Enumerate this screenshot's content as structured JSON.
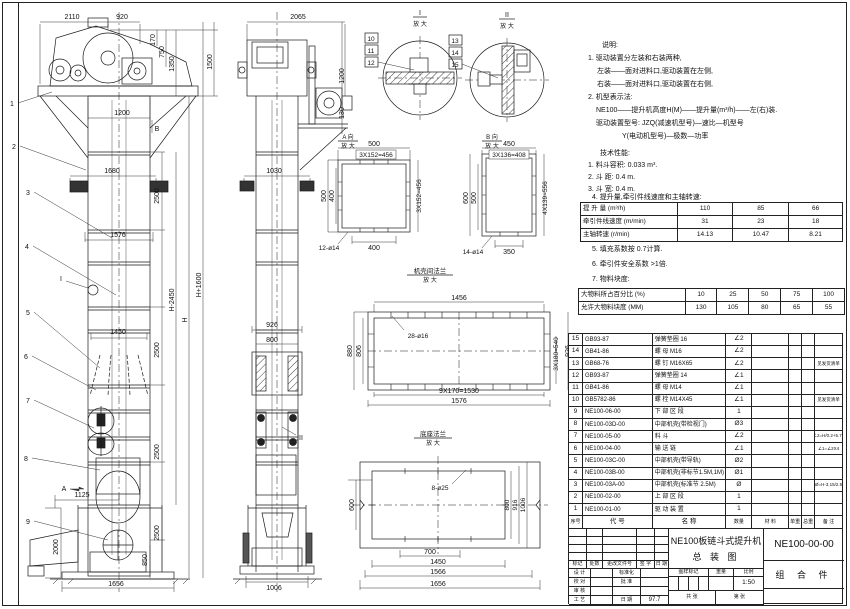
{
  "notes": {
    "title": "说明:",
    "lines": [
      "1. 驱动装置分左装和右装两种,",
      "左装——面对进料口,驱动装置在左侧,",
      "右装——面对进料口,驱动装置在右侧,",
      "2. 机型表示法:",
      "NE100——提升机高度H(M)——提升量(m³/h)——左(右)装.",
      "驱动装置型号: JZQ(减速机型号)—速比—机型号",
      "Y(电动机型号)—极数—功率"
    ]
  },
  "tech": {
    "title": "技术性能:",
    "items_before": [
      "1. 料斗容积: 0.033 m³.",
      "2. 斗  距: 0.4 m.",
      "3. 斗  宽: 0.4 m.",
      "4. 提升量,牵引件线速度和主轴转速:"
    ],
    "perf_table": {
      "rows": [
        {
          "label": "提 升 量  (m³/h)",
          "c1": "110",
          "c2": "85",
          "c3": "66"
        },
        {
          "label": "牵引件线速度 (m/min)",
          "c1": "31",
          "c2": "23",
          "c3": "18"
        },
        {
          "label": "主轴转速  (r/min)",
          "c1": "14.13",
          "c2": "10.47",
          "c3": "8.21"
        }
      ]
    },
    "items_after": [
      "5. 填充系数按 0.7计算.",
      "6. 牵引件安全系数 >1倍.",
      "7. 物料块度:"
    ],
    "block_table": {
      "rows": [
        {
          "label": "大物料所占百分比 (%)",
          "c1": "10",
          "c2": "25",
          "c3": "50",
          "c4": "75",
          "c5": "100"
        },
        {
          "label": "允许大物料块度 (MM)",
          "c1": "130",
          "c2": "105",
          "c3": "80",
          "c4": "65",
          "c5": "55"
        }
      ]
    }
  },
  "bom": {
    "headers": {
      "no": "序号",
      "code": "代  号",
      "name": "名  称",
      "qty": "数量",
      "material": "材 料",
      "uw": "单重",
      "tw": "总重",
      "remark": "备 注"
    },
    "rows": [
      {
        "no": "15",
        "code": "GB93-87",
        "name": "弹簧垫圈 16",
        "qty": "∠2",
        "material": "",
        "uw": "",
        "tw": "",
        "remark": ""
      },
      {
        "no": "14",
        "code": "GB41-86",
        "name": "螺 母 M16",
        "qty": "∠2",
        "material": "",
        "uw": "",
        "tw": "",
        "remark": ""
      },
      {
        "no": "13",
        "code": "GB68-76",
        "name": "螺 钉 M16X65",
        "qty": "∠2",
        "material": "",
        "uw": "",
        "tw": "",
        "remark": "见发货清单"
      },
      {
        "no": "12",
        "code": "GB93-87",
        "name": "弹簧垫圈 14",
        "qty": "∠1",
        "material": "",
        "uw": "",
        "tw": "",
        "remark": ""
      },
      {
        "no": "11",
        "code": "GB41-86",
        "name": "螺 母 M14",
        "qty": "∠1",
        "material": "",
        "uw": "",
        "tw": "",
        "remark": ""
      },
      {
        "no": "10",
        "code": "GB5782-86",
        "name": "螺 栓 M14X45",
        "qty": "∠1",
        "material": "",
        "uw": "",
        "tw": "",
        "remark": "见发货清单"
      },
      {
        "no": "9",
        "code": "NE100-06-00",
        "name": "下 部 区 段",
        "qty": "1",
        "material": "",
        "uw": "",
        "tw": "",
        "remark": ""
      },
      {
        "no": "8",
        "code": "NE100-03D-00",
        "name": "中部机壳(带检视门)",
        "qty": "Ø3",
        "material": "",
        "uw": "",
        "tw": "",
        "remark": ""
      },
      {
        "no": "7",
        "code": "NE100-05-00",
        "name": "料 斗",
        "qty": "∠2",
        "material": "",
        "uw": "",
        "tw": "",
        "remark": "∠2=H/0.2+5.75"
      },
      {
        "no": "6",
        "code": "NE100-04-00",
        "name": "输 送 链",
        "qty": "∠1",
        "material": "",
        "uw": "",
        "tw": "",
        "remark": "∠1=∠2X4"
      },
      {
        "no": "5",
        "code": "NE100-03C-00",
        "name": "中部机壳(带导轨)",
        "qty": "Ø2",
        "material": "",
        "uw": "",
        "tw": "",
        "remark": ""
      },
      {
        "no": "4",
        "code": "NE100-03B-00",
        "name": "中部机壳(非标节1.5M,1M)",
        "qty": "Ø1",
        "material": "",
        "uw": "",
        "tw": "",
        "remark": ""
      },
      {
        "no": "3",
        "code": "NE100-03A-00",
        "name": "中部机壳(标准节 2.5M)",
        "qty": "Ø",
        "material": "",
        "uw": "",
        "tw": "",
        "remark": "Ø=H-3.15/2.5"
      },
      {
        "no": "2",
        "code": "NE100-02-00",
        "name": "上 部 区 段",
        "qty": "1",
        "material": "",
        "uw": "",
        "tw": "",
        "remark": ""
      },
      {
        "no": "1",
        "code": "NE100-01-00",
        "name": "驱 动 装 置",
        "qty": "1",
        "material": "",
        "uw": "",
        "tw": "",
        "remark": ""
      }
    ]
  },
  "title_block": {
    "rev_headers": [
      "标记",
      "处数",
      "更改文件号",
      "签 字",
      "日 期"
    ],
    "roles": [
      {
        "label": "设 计",
        "mid": "标准化",
        "mval": ""
      },
      {
        "label": "校 对",
        "mid": "批 准",
        "mval": ""
      },
      {
        "label": "审 核",
        "mid": "",
        "mval": ""
      },
      {
        "label": "工 艺",
        "mid": "日 期",
        "mval": "97.7"
      }
    ],
    "title_line1": "NE100板链斗式提升机",
    "title_line2": "总  装  图",
    "drawing_no": "NE100-00-00",
    "part_type": "组 合 件",
    "stamp_headers": [
      "图样标记",
      "重量",
      "比例"
    ],
    "scale": "1:50",
    "sheet_count": "共    张",
    "sheet_no": "第    张"
  },
  "dims": {
    "front": {
      "a2110": "2110",
      "a920": "920",
      "a170": "170",
      "a750": "750",
      "a1350": "1350",
      "a1500": "1500",
      "a1200": "1200",
      "a1680": "1680",
      "a2500": "2500",
      "a1576": "1576",
      "ahp": "H+1600",
      "ahm": "H-2450",
      "ah": "H",
      "a1450": "1450",
      "a1125": "1125",
      "a2000": "2000",
      "a850": "850",
      "a1656": "1656"
    },
    "side": {
      "a2065": "2065",
      "a1200": "1200",
      "a130": "130",
      "a1030": "1030",
      "a926": "926",
      "a800": "800",
      "a1006": "1006"
    },
    "da": {
      "t1": "A 向",
      "t2": "放 大",
      "a500": "500",
      "p456": "3X152=456",
      "a400": "400",
      "holes": "12-ø14"
    },
    "db": {
      "t1": "B 向",
      "t2": "放 大",
      "a450": "450",
      "p408": "3X136=408",
      "a600": "600",
      "a500": "500",
      "p556": "4X139=556",
      "a350": "350",
      "holes": "14-ø14"
    },
    "f1": {
      "t1": "机壳间法兰",
      "t2": "放 大",
      "a1456": "1456",
      "holes": "28-ø16",
      "a880": "880",
      "a806": "806",
      "p540": "3X180=540",
      "a926": "926",
      "p1530": "9X170=1530",
      "a1576": "1576"
    },
    "f2": {
      "t1": "底座法兰",
      "t2": "放 大",
      "holes": "8-ø25",
      "a600": "600",
      "a800": "800",
      "a916": "916",
      "a1006": "1006",
      "a700": "700",
      "a1450": "1450",
      "a1566": "1566",
      "a1656": "1656"
    },
    "dc": {
      "t1": "I",
      "t2": "II",
      "sub": "放 大"
    }
  },
  "leaders": {
    "n1": "1",
    "n2": "2",
    "n3": "3",
    "n4": "4",
    "n5": "5",
    "n6": "6",
    "n7": "7",
    "n8": "8",
    "n9": "9",
    "n10": "10",
    "n11": "11",
    "n12": "12",
    "n13": "13",
    "n14": "14",
    "n15": "15",
    "a": "A",
    "b": "B",
    "i": "I",
    "ii": "II"
  }
}
